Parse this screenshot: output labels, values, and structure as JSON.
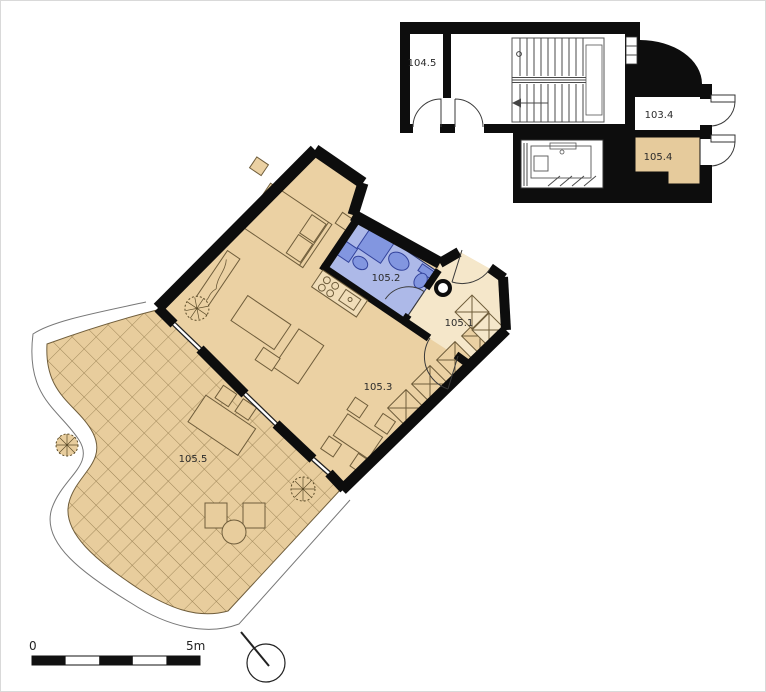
{
  "title": "apartment-floor-plan",
  "rooms": {
    "r104_5": {
      "label": "104.5"
    },
    "r103_4": {
      "label": "103.4"
    },
    "r105_4": {
      "label": "105.4"
    },
    "r105_2": {
      "label": "105.2"
    },
    "r105_1": {
      "label": "105.1"
    },
    "r105_3": {
      "label": "105.3"
    },
    "r105_5": {
      "label": "105.5"
    }
  },
  "scale_bar": {
    "start_label": "0",
    "end_label": "5m"
  },
  "icons": {
    "north_arrow": "north-direction-circle",
    "stairs": "staircase",
    "elevator": "elevator-shaft",
    "plant": "potted-plant",
    "scale_bar": "graphic-scale-5m"
  },
  "colors": {
    "wall": "#0d0d0d",
    "floor_tan": "#ebd1a3",
    "floor_hall": "#f5e7ca",
    "floor_terrace": "#e8cd9d",
    "floor_storage": "#e6cb9c",
    "bath_floor": "#adb9e8",
    "bath_fixture": "#8296e0",
    "grid_line": "#9b8355"
  }
}
